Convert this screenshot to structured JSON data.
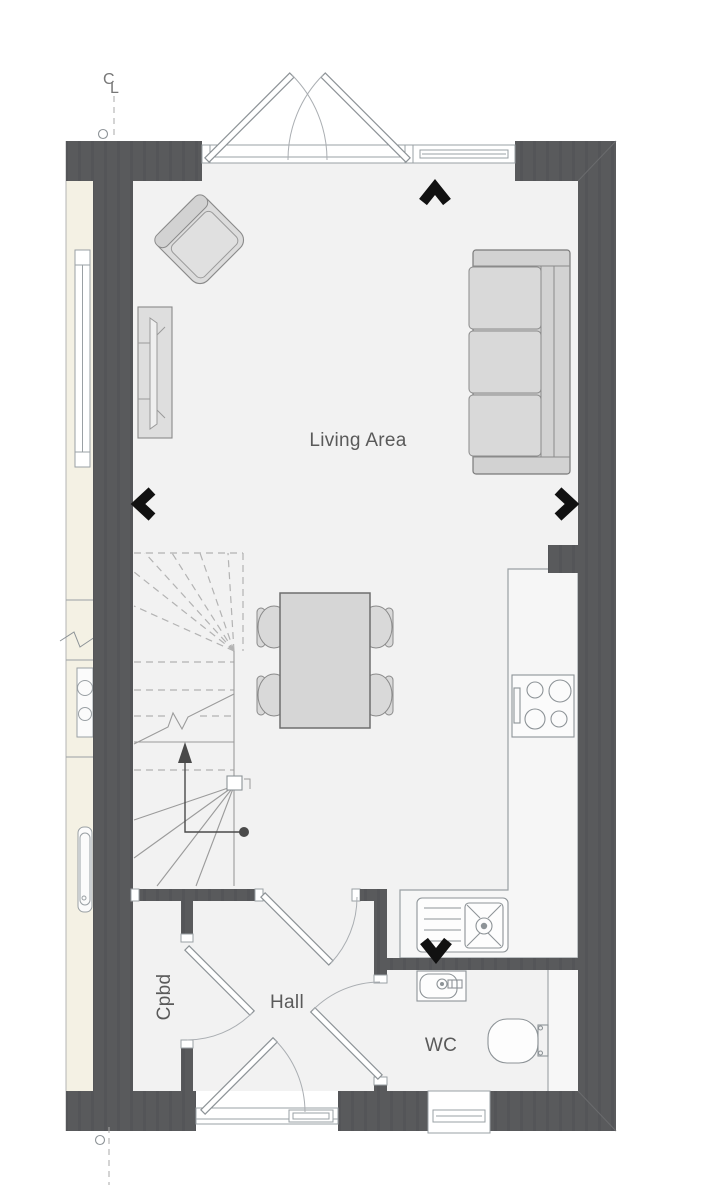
{
  "labels": {
    "living_area": "Living Area",
    "hall": "Hall",
    "cupboard": "Cpbd",
    "wc": "WC"
  },
  "markers": {
    "centerline_top_c": "C",
    "centerline_top_l": "L"
  },
  "direction_markers": [
    "up",
    "left",
    "right",
    "down"
  ],
  "colors": {
    "background": "#ffffff",
    "floor": "#f2f2f2",
    "neighbor_floor": "#f4f1e4",
    "wall": "#595a5c",
    "wall_stripe": "#545558",
    "fixture_line": "#8d9397",
    "thin_line": "#9aa0a4",
    "dashed_line": "#b3b3b3",
    "furniture_fill": "#d6d6d6",
    "cushion_fill": "#d9d9d9",
    "arrow_black": "#111111",
    "stair_arrow": "#4a4a4a",
    "label_text": "#5a5a5a"
  }
}
